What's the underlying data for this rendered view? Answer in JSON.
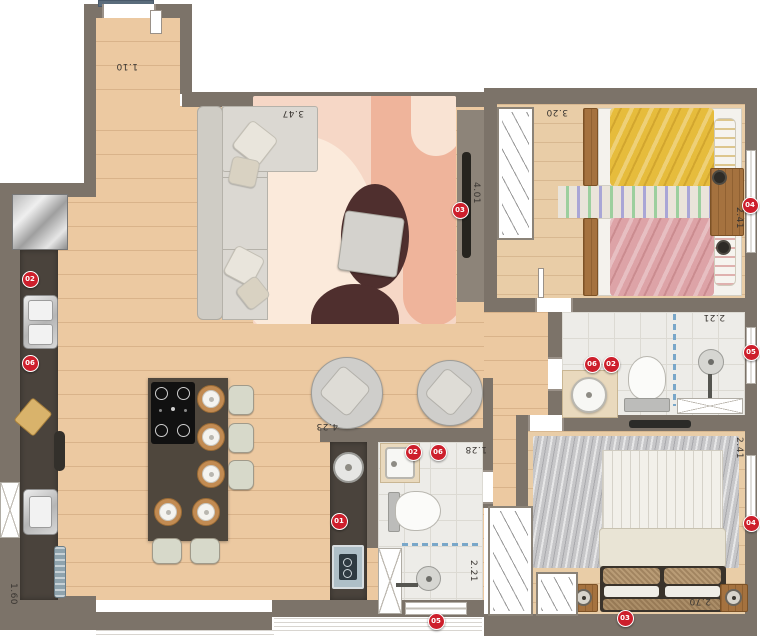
{
  "plan_title": "apartment-floor-plan",
  "colors": {
    "wall": "#7c7369",
    "wood_floor": "#ecc9a1",
    "tile_floor": "#edece8",
    "counter_dark": "#4a433c",
    "badge_red": "#cd1f2c",
    "sofa_gray": "#d9d6d0",
    "rug_living_base": "#f6d7c6",
    "rug_living_dark": "#4f2f2e",
    "bed_yellow": "#e6bc3c",
    "bed_pink": "#dda3a7",
    "rug_master_gray": "#c7c7c9",
    "glass_partition_blue": "#79a7c9",
    "doormat_blue": "#5a6c7c"
  },
  "dimensions": [
    {
      "label": "1.10",
      "x": 127,
      "y": 66,
      "rot": 180
    },
    {
      "label": "3.47",
      "x": 293,
      "y": 113,
      "rot": 180
    },
    {
      "label": "4.01",
      "x": 476,
      "y": 193,
      "rot": 90
    },
    {
      "label": "3.20",
      "x": 557,
      "y": 112,
      "rot": 180
    },
    {
      "label": "2.41",
      "x": 739,
      "y": 218,
      "rot": 90
    },
    {
      "label": "2.21",
      "x": 714,
      "y": 317,
      "rot": 180
    },
    {
      "label": "4.23",
      "x": 327,
      "y": 426,
      "rot": 180
    },
    {
      "label": "1.28",
      "x": 476,
      "y": 449,
      "rot": 180
    },
    {
      "label": "2.21",
      "x": 473,
      "y": 571,
      "rot": 90
    },
    {
      "label": "1.60",
      "x": 13,
      "y": 594,
      "rot": 90
    },
    {
      "label": "2.41",
      "x": 739,
      "y": 448,
      "rot": 90
    },
    {
      "label": "2.70",
      "x": 700,
      "y": 601,
      "rot": 180
    }
  ],
  "badges": [
    {
      "label": "02",
      "x": 30,
      "y": 279
    },
    {
      "label": "06",
      "x": 30,
      "y": 363
    },
    {
      "label": "03",
      "x": 460,
      "y": 210
    },
    {
      "label": "04",
      "x": 750,
      "y": 205
    },
    {
      "label": "06",
      "x": 592,
      "y": 364
    },
    {
      "label": "02",
      "x": 611,
      "y": 364
    },
    {
      "label": "05",
      "x": 751,
      "y": 352
    },
    {
      "label": "02",
      "x": 413,
      "y": 452
    },
    {
      "label": "06",
      "x": 438,
      "y": 452
    },
    {
      "label": "01",
      "x": 339,
      "y": 521
    },
    {
      "label": "05",
      "x": 436,
      "y": 621
    },
    {
      "label": "04",
      "x": 751,
      "y": 523
    },
    {
      "label": "03",
      "x": 625,
      "y": 618
    }
  ]
}
